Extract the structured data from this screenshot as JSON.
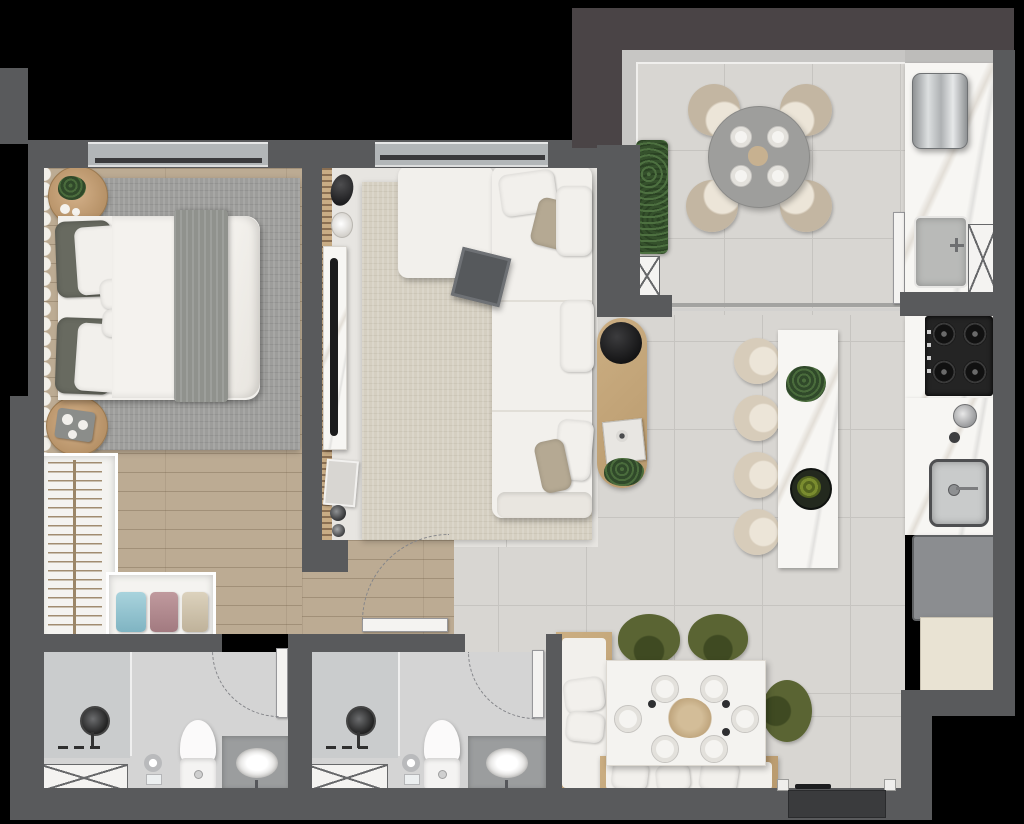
{
  "scene": {
    "type": "apartment-floor-plan-render",
    "view": "top-down-3d",
    "text_visible": "none",
    "canvas": {
      "width": 1024,
      "height": 824
    }
  },
  "palette": {
    "bg": "#000000",
    "wall": "#595a5c",
    "wallBrown": "#4a4446",
    "wallEntry": "#3a3b3d",
    "tile": "#d8d6d2",
    "tileLine": "#c6c4c0",
    "livingFloor": "#e7e5e1",
    "wood": "#bcab93",
    "rugGray": "#9d9d9b",
    "rugBeige": "#d5cfc1",
    "fabric": "#f2f0ec",
    "pillowDark": "#686a60",
    "throw": "#90928d",
    "marble": "#f7f6f3",
    "stool": "#d7ccba",
    "stoolHi": "#ece5d8",
    "chairGreen": "#5a6433",
    "chairGreenDk": "#3f4a22",
    "plant": "#3c5a31",
    "blackDecor": "#1f1f1f",
    "railing": "#c7c6c4",
    "window": "#b2b6b8",
    "bath": "#d4d4d4",
    "glassZone": "#c8cacb",
    "vanity": "#9b9d9e",
    "appliance": "#8b8d90",
    "cream": "#e9e3d3",
    "cooktop": "#242424",
    "doorWhite": "#f4f3f1",
    "arc": "#85868a",
    "woodFurn": "#c5a87c"
  },
  "rooms": [
    {
      "name": "bedroom",
      "furniture": [
        "double-bed",
        "gray-throw-blanket",
        "dark-pillows",
        "white-pillows",
        "round-nightstand-with-plant",
        "round-nightstand-with-tray",
        "gray-area-rug",
        "wavy-curtain",
        "wall-tv",
        "window"
      ]
    },
    {
      "name": "walk-in-closet",
      "furniture": [
        "open-wardrobe-with-hangers",
        "shelf-with-folded-towels"
      ]
    },
    {
      "name": "living-room",
      "furniture": [
        "l-shaped-white-sofa",
        "scatter-pillows",
        "cube-ottoman",
        "oval-wood-coffee-table-with-black-tray",
        "media-console-wall-with-slats",
        "beige-rug",
        "window"
      ]
    },
    {
      "name": "balcony-terrace",
      "furniture": [
        "round-dining-table-4-settings",
        "four-beige-chairs",
        "long-planter",
        "ac-unit-marked-x",
        "glass-railing",
        "sliding-door-track"
      ]
    },
    {
      "name": "kitchen",
      "furniture": [
        "stainless-water-heater",
        "laundry-sink",
        "appliance-space-marked-x",
        "four-burner-cooktop",
        "kitchen-sink",
        "marble-counter",
        "under-counter-appliance",
        "cream-cabinet",
        "marble-island",
        "four-beige-stools",
        "herb-plant",
        "bowl"
      ]
    },
    {
      "name": "dining-area",
      "furniture": [
        "white-dining-table-6-settings",
        "dried-flower-centerpiece",
        "two-green-chairs",
        "one-green-side-chair",
        "l-shaped-wood-bench-with-pillows"
      ]
    },
    {
      "name": "bathroom-1",
      "furniture": [
        "shower-column",
        "shower-tray-marked-x",
        "toilet",
        "vanity-with-oval-sink",
        "toilet-paper-holder",
        "swing-door"
      ]
    },
    {
      "name": "bathroom-2",
      "furniture": [
        "shower-column",
        "shower-tray-marked-x",
        "toilet",
        "vanity-with-oval-sink",
        "toilet-paper-holder",
        "swing-door"
      ]
    },
    {
      "name": "hallway",
      "furniture": [
        "wood-floor",
        "open-door-leaf",
        "door-swing-arc"
      ]
    },
    {
      "name": "entry",
      "furniture": [
        "entrance-door-recess",
        "door-handle"
      ]
    }
  ],
  "counts": {
    "balcony_chairs": 4,
    "island_stools": 4,
    "dining_place_settings": 6,
    "balcony_place_settings": 4,
    "green_chairs": 3,
    "bathrooms": 2,
    "x_marked_boxes": 4,
    "cooktop_burners": 4
  }
}
